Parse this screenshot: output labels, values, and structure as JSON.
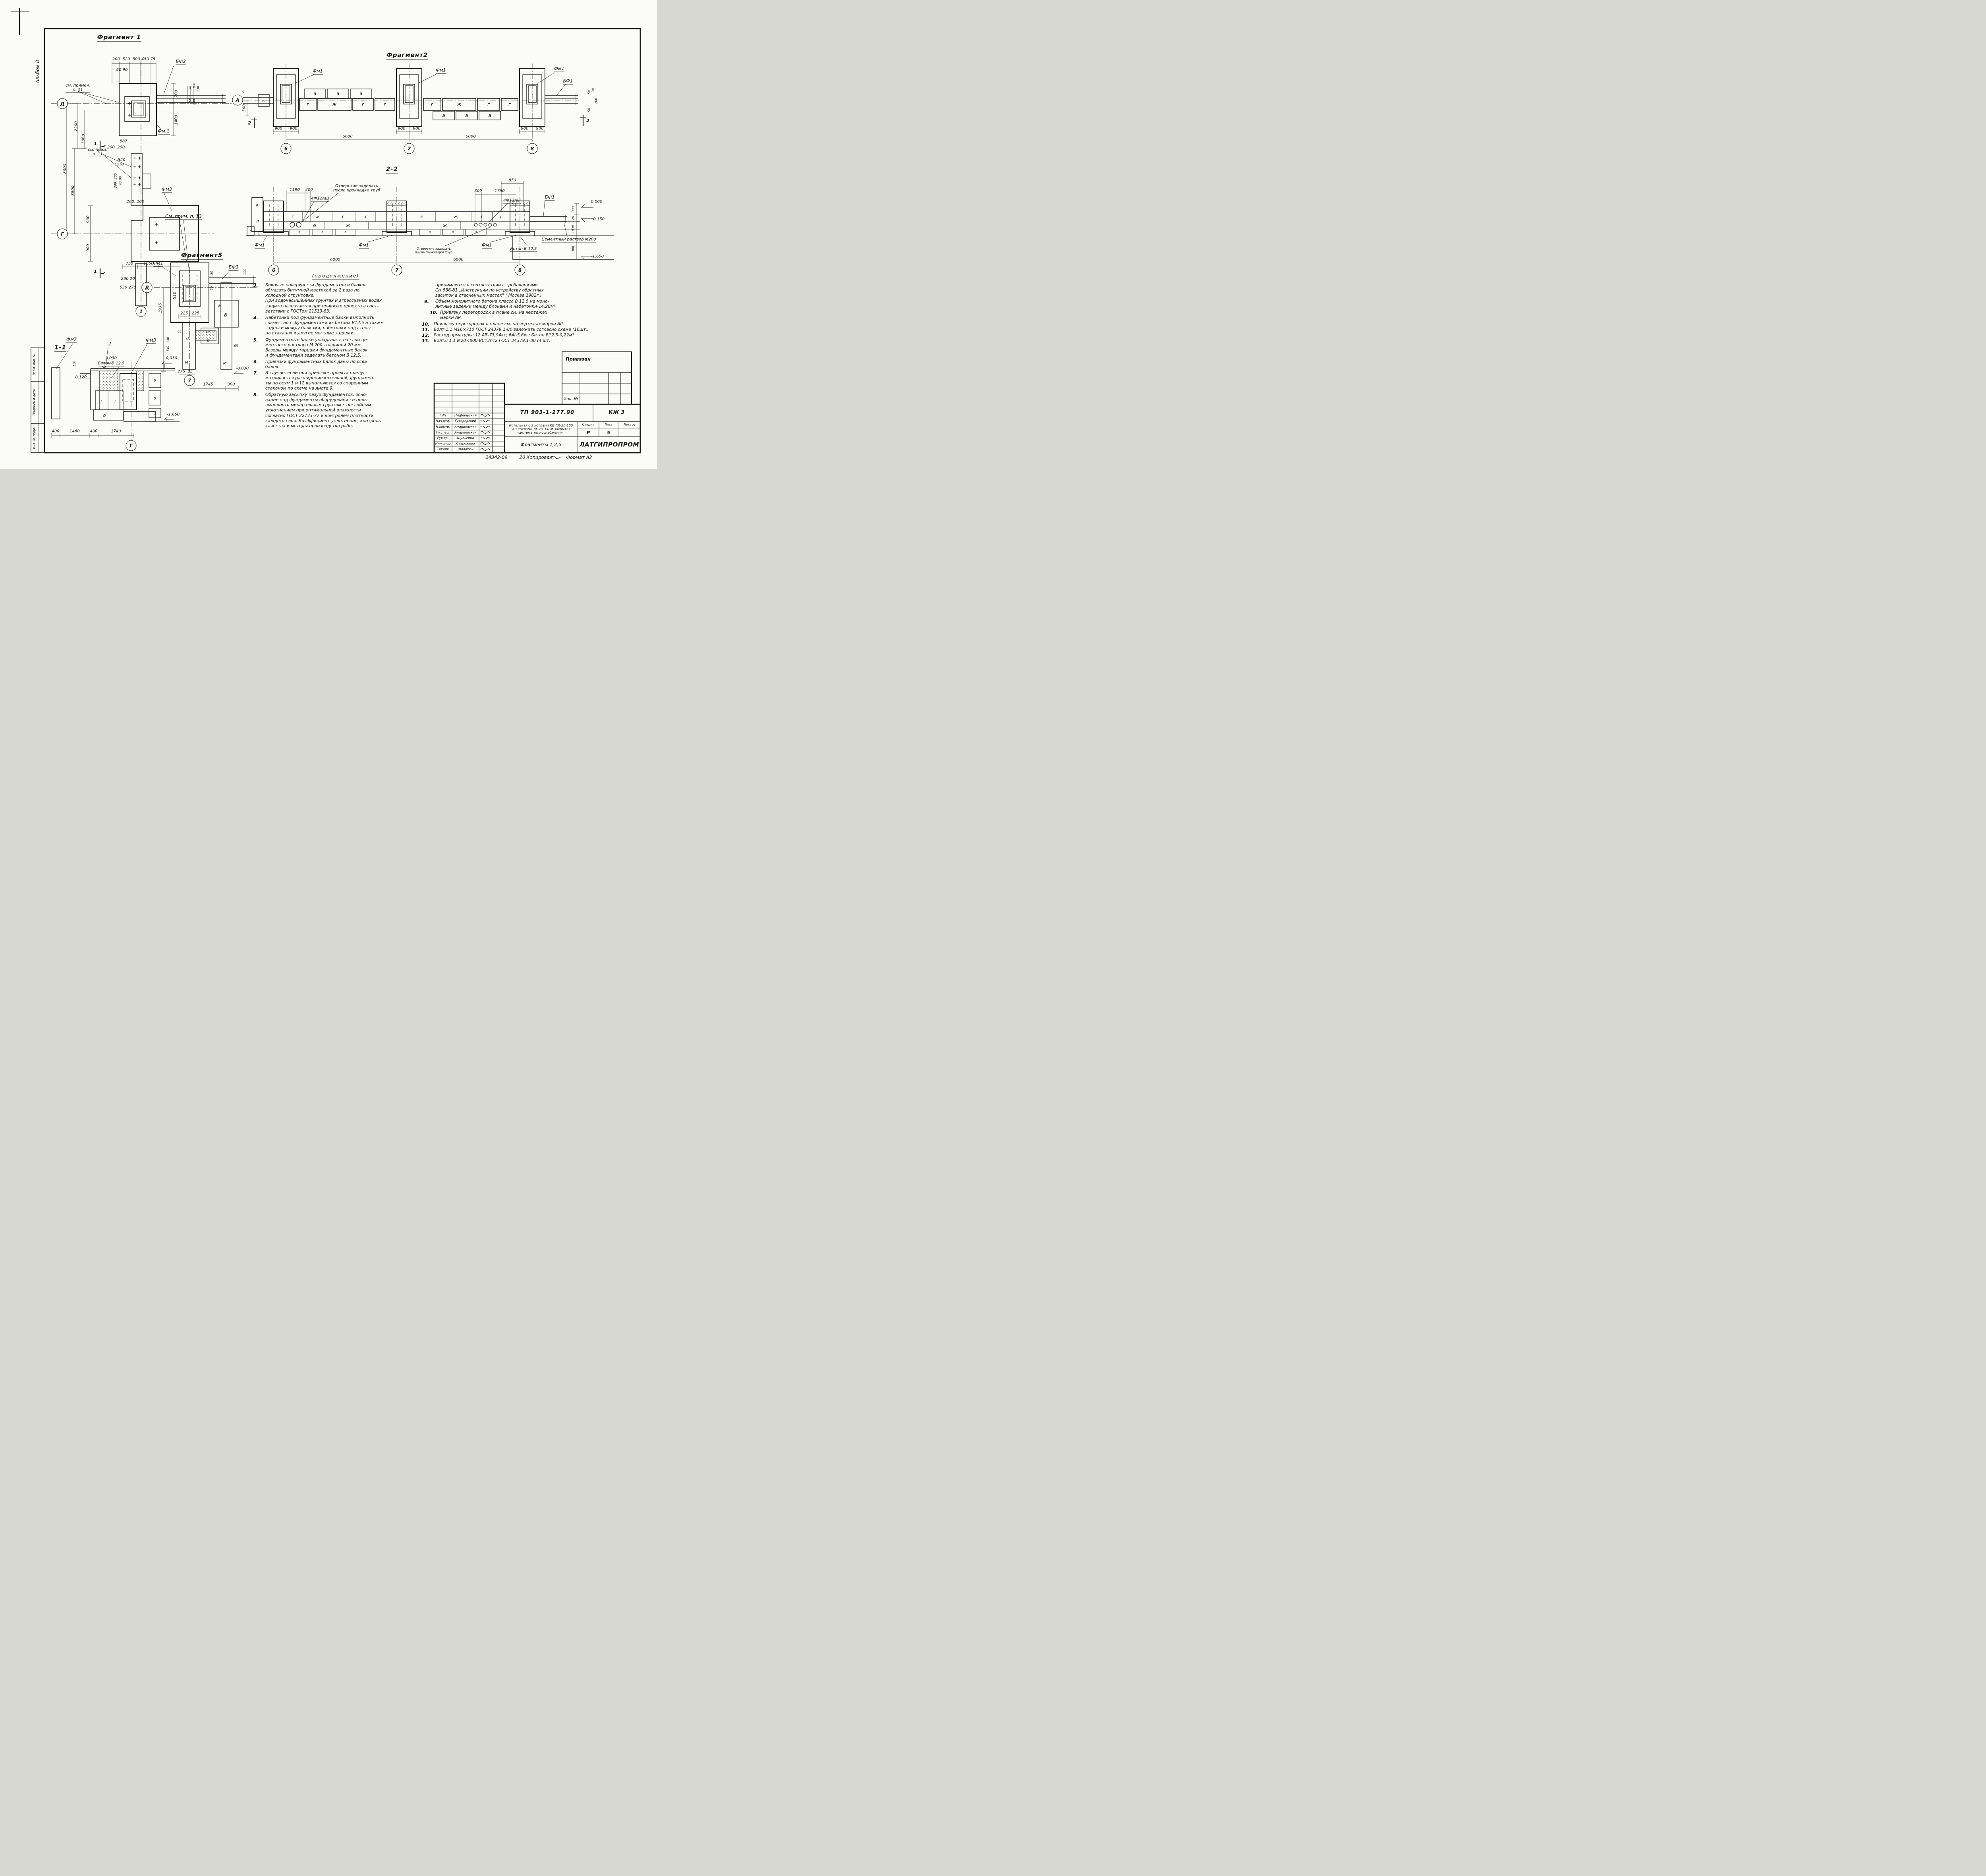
{
  "sheet": {
    "album": "Альбом 8",
    "stamp1": "Взам. инв. №",
    "stamp2": "Подпись и дата",
    "stamp3": "Инв. № подл.",
    "footer": {
      "doc": "24342-09",
      "copies": "20",
      "copied": "Копировал",
      "format": "Формат А2"
    }
  },
  "axes": {
    "a": "А",
    "d": "Д",
    "g": "Г",
    "n1": "1",
    "n6": "6",
    "n7": "7",
    "n8": "8"
  },
  "letters": {
    "a": "а",
    "b": "б",
    "v": "в",
    "g": "г",
    "e": "е",
    "zh": "ж",
    "k": "к",
    "l": "л",
    "m": "м"
  },
  "levels": {
    "zero": "0.000",
    "m015": "-0,150",
    "m165": "-1,650",
    "m003": "-0,030",
    "m012": "-0,120"
  },
  "frag1": {
    "title": "Фрагмент 1",
    "dim_top": "200  520  500 450 75",
    "d9090a": "90 90",
    "bf2": "БФ2",
    "note11a": "см. примеч.\nп. 11",
    "d2200": "2200",
    "d1860": "1860",
    "d8000": "8000",
    "d3800": "3800",
    "d700": "700",
    "d1400": "1400",
    "d50a": "50",
    "d100a": "100",
    "d130": "130",
    "d50b": "50",
    "d100b": "100",
    "fm1": "Фм 1",
    "fm3": "Фм3",
    "sec1": "1",
    "d587": "587",
    "d200200a": "200  200",
    "note11b": "см. прим.\nп. 11",
    "d520": "520",
    "d9090b": "90 90",
    "s200": "200",
    "s90": "90",
    "d200200b": "200. 200",
    "d900": "900",
    "d750": "750",
    "d1050": "1050",
    "d280_20": "280 20",
    "d530_270": "530 270"
  },
  "frag2": {
    "title": "Фрагмент2",
    "fm1": "Фм1",
    "bf1": "БФ1",
    "d5": "5",
    "d500": "500",
    "d900900": "900      900",
    "d6000": "6000",
    "d50": "50",
    "d30": "30",
    "d200": "200",
    "sec2": "2"
  },
  "sec22": {
    "title": "2-2",
    "d1190": "1190",
    "d300a": "300",
    "bars1": "4Ф12АШ",
    "hole": "Отверстие заделать\nпосле прокладки труб",
    "d850": "850",
    "d300b": "300",
    "d1750": "1750",
    "bars2": "4Ф12АIII",
    "bf1": "БФ1",
    "c300a": "300",
    "c20": "20",
    "c1030": "1030",
    "c300b": "300",
    "fm1": "Фм1",
    "cem": "Цементный раствор М200",
    "bet": "Бетон В 12,5",
    "d6000": "6000"
  },
  "frag5": {
    "title": "Фрагмент5",
    "prim13": "См. прим. п. 13",
    "fm1": "Фм1",
    "bf3": "БФ3",
    "d50": "50",
    "d200": "200",
    "d510": "510",
    "d1935": "1935",
    "d225225": "225   225",
    "d65": "65",
    "d140": "140",
    "d27525": "275  25",
    "d1745": "1745",
    "d300": "300"
  },
  "sec11": {
    "title": "1-1",
    "fm7": "Фм7",
    "fm3": "Фм3",
    "g2": "2",
    "beton": "Бетон В 12,5",
    "d120": "120",
    "d400a": "400",
    "d1460": "1460",
    "d400b": "400",
    "d1740": "1740"
  },
  "notes_left": {
    "heading": "(продолжение)",
    "n3": "3.",
    "t3": "Боковые поверхности фундаментов и блоков\nобмазать битумной мастикой за 2 раза по\nхолодной огрунтовке.\nПри водонасыщенных грунтах и агрессивных водах\nзащита назначается при привязке проекта в соот-\nветствии с ГОСТом 21513-83.",
    "n4": "4.",
    "t4": "Набетонки под фундаментные балки выполнить\nсовместно с фундаментами из бетона В12.5 а также\nзаделки между блоками, набетонки под стены\nна стаканах и другие местные заделки.",
    "n5": "5.",
    "t5": "Фундаментные балки укладывать на слой це-\nментного раствора М 200 толщиной 20 мм.\nЗазоры между торцами фундаментных балок\nи фундаментами заделать бетоном В 12.5.",
    "n6": "6.",
    "t6": "Привязки фундаментных балок даны по осям\nбалок.",
    "n7": "7.",
    "t7": "В случае, если при привязке проекта предус-\nматривается расширение котельной, фундамен-\nты по осям 1 и 12 выполняются со спаренным\nстаканом по схеме на листе 9.",
    "n8": "8.",
    "t8": "Обратную засыпку пазух фундаментов, осно-\nвание под фундаменты оборудования и полы\nвыполнять минеральным грунтом с послойным\nуплотнением при оптимальной влажности\nсогласно ГОСТ 22733-77 и контролем плотности\nкаждого слоя. Коэффициент уплотнения, контроль\nкачества и методы производства работ"
  },
  "notes_right": {
    "intro": "принимаются в соответствии с требованиями\nСН 536-81 „Инструкции по устройству обратных\nзасыпок в стесненных местах\" ( Москва 1982г.)",
    "n9": "9.",
    "t9": "Объем монолитного бетона класса В 12,5 на моно-\nлитные заделки между блоками и набетонки-14,28м³",
    "n10a": "10.",
    "t10a": "Привязку перегородок в плане см. на чертежах\nмарки АР.",
    "n10": "10.",
    "t10": "Привязку перегородок в плане см. на чертежах марки АР.",
    "n11": "11.",
    "t11": "Болт 1.1 М16×710 ГОСТ 24379.1-80 заложить согласно схеме (16шт.)",
    "n12": "12.",
    "t12": "Расход арматуры: 12 АⅢ-73,94кг; 6АⅠ-5,6кг; Бетон В12.5-0,22м³",
    "n13": "13.",
    "t13": "Болты 1.1 М20×800 ВСт3пс2 ГОСТ 24379.1-80 (4 шт)"
  },
  "privyazan": {
    "title": "Привязан",
    "inv": "Инв. №"
  },
  "tb": {
    "doc": "ТП 903-1-277.90",
    "code": "КЖ 3",
    "desc": "Котельная с 3 котлами КВ-ГМ-35-150\nи 3 котлами ДЕ-25-14ГМ закрытая\nсистема теплоснабжения.",
    "stage_h": "Стадия",
    "sheet_h": "Лист",
    "sheets_h": "Листов",
    "stage": "Р",
    "sheet": "5",
    "subtitle": "Фрагменты 1,2,5",
    "org": "ЛАТГИПРОПРОМ",
    "r1": "ГИП",
    "f1": "Нидбальский",
    "r2": "Нач.отд.",
    "f2": "Гутерерский",
    "r3": "Н.контр.",
    "f3": "Андриевская",
    "r4": "Гл.спец.",
    "f4": "Андриевская",
    "r5": "Рук.гр.",
    "f5": "Шульгина",
    "r6": "Инженер",
    "f6": "Старожева",
    "r7": "Техник",
    "f7": "Шолотюк"
  }
}
